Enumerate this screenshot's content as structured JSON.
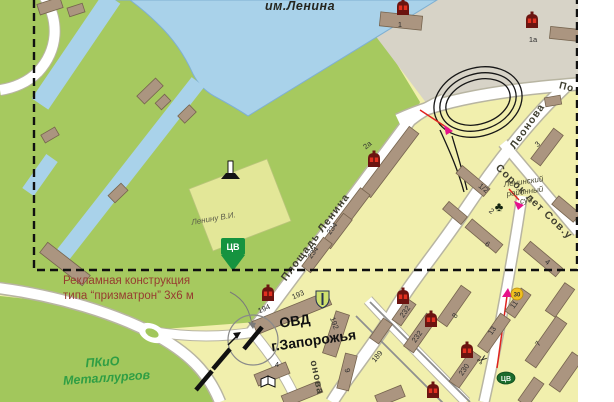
{
  "labels": {
    "park_top": "им.Ленина",
    "monument": "Ленину В.И.",
    "court1": "Ленинский",
    "court2": "районный",
    "court3": "суд",
    "ovd1": "ОВД",
    "ovd2": "г.Запорожья",
    "pkio1": "ПКиО",
    "pkio2": "Металлургов",
    "note1": "Рекламная конструкция",
    "note2": "типа “призматрон” 3х6 м",
    "marker_cv": "ЦВ",
    "oval_cv": "ЦВ",
    "sign_30": "30"
  },
  "streets": {
    "ploshad_lenina": "Площадь Ленина",
    "leonova": "Леонова",
    "sorok": "Сорок лет Сов.у",
    "p_top": "По",
    "onova": "онова"
  },
  "colors": {
    "park_green": "#a6c95f",
    "pkio_green": "#a2c75c",
    "water": "#a9d2ea",
    "water_edge": "#7fb0d2",
    "urban_gray": "#d7d3c7",
    "block_yellow": "#f1efad",
    "square_yellow_green": "#e3e798",
    "building_brown": "#ab9580",
    "building_edge": "#76644e",
    "road_white": "#ffffff",
    "road_casing": "#b8b5a2",
    "dashed_border": "#101010",
    "shop_icon_dark": "#6b1410",
    "shop_icon_red": "#e23020",
    "route_red": "#e0231e",
    "route_magenta": "#e6128a",
    "marker_green": "#15933f",
    "annotation_red": "#963c30",
    "tram_black": "#161616",
    "tram_gray": "#8f8f8f"
  },
  "buildings": [
    {
      "x": 50,
      "y": 6,
      "w": 24,
      "h": 11,
      "r": -18
    },
    {
      "x": 76,
      "y": 10,
      "w": 16,
      "h": 9,
      "r": -18
    },
    {
      "x": 150,
      "y": 91,
      "w": 26,
      "h": 11,
      "r": -44
    },
    {
      "x": 163,
      "y": 102,
      "w": 13,
      "h": 9,
      "r": -44
    },
    {
      "x": 187,
      "y": 114,
      "w": 16,
      "h": 10,
      "r": -44
    },
    {
      "x": 50,
      "y": 135,
      "w": 16,
      "h": 9,
      "r": -30
    },
    {
      "x": 118,
      "y": 193,
      "w": 18,
      "h": 10,
      "r": -44
    },
    {
      "x": 65,
      "y": 264,
      "w": 54,
      "h": 13,
      "r": 38
    },
    {
      "x": 401,
      "y": 21,
      "w": 42,
      "h": 14,
      "r": 6
    },
    {
      "x": 565,
      "y": 34,
      "w": 30,
      "h": 12,
      "r": 6
    },
    {
      "x": 553,
      "y": 101,
      "w": 16,
      "h": 9,
      "r": -10
    },
    {
      "x": 390,
      "y": 162,
      "w": 80,
      "h": 12,
      "r": -53
    },
    {
      "x": 352,
      "y": 209,
      "w": 44,
      "h": 12,
      "r": -53
    },
    {
      "x": 547,
      "y": 147,
      "w": 38,
      "h": 12,
      "r": -53
    },
    {
      "x": 566,
      "y": 209,
      "w": 28,
      "h": 11,
      "r": 40
    },
    {
      "x": 473,
      "y": 181,
      "w": 36,
      "h": 10,
      "r": 40
    },
    {
      "x": 455,
      "y": 213,
      "w": 24,
      "h": 10,
      "r": 40
    },
    {
      "x": 484,
      "y": 236,
      "w": 40,
      "h": 11,
      "r": 40
    },
    {
      "x": 543,
      "y": 259,
      "w": 42,
      "h": 11,
      "r": 40
    },
    {
      "x": 337,
      "y": 231,
      "w": 36,
      "h": 11,
      "r": -53
    },
    {
      "x": 317,
      "y": 255,
      "w": 36,
      "h": 11,
      "r": -53
    },
    {
      "x": 292,
      "y": 313,
      "w": 80,
      "h": 14,
      "r": -22
    },
    {
      "x": 336,
      "y": 334,
      "w": 14,
      "h": 44,
      "r": 18
    },
    {
      "x": 347,
      "y": 372,
      "w": 12,
      "h": 36,
      "r": 14
    },
    {
      "x": 272,
      "y": 374,
      "w": 34,
      "h": 12,
      "r": -22
    },
    {
      "x": 302,
      "y": 394,
      "w": 40,
      "h": 12,
      "r": -22
    },
    {
      "x": 454,
      "y": 306,
      "w": 42,
      "h": 12,
      "r": -55
    },
    {
      "x": 420,
      "y": 333,
      "w": 40,
      "h": 12,
      "r": -55
    },
    {
      "x": 404,
      "y": 312,
      "w": 26,
      "h": 11,
      "r": -55
    },
    {
      "x": 494,
      "y": 333,
      "w": 40,
      "h": 12,
      "r": -55
    },
    {
      "x": 518,
      "y": 303,
      "w": 28,
      "h": 12,
      "r": -55
    },
    {
      "x": 546,
      "y": 342,
      "w": 54,
      "h": 13,
      "r": -55
    },
    {
      "x": 465,
      "y": 369,
      "w": 38,
      "h": 12,
      "r": -55
    },
    {
      "x": 381,
      "y": 331,
      "w": 24,
      "h": 11,
      "r": -55
    },
    {
      "x": 560,
      "y": 300,
      "w": 34,
      "h": 12,
      "r": -55
    },
    {
      "x": 566,
      "y": 372,
      "w": 40,
      "h": 13,
      "r": -55
    },
    {
      "x": 531,
      "y": 392,
      "w": 28,
      "h": 12,
      "r": -55
    },
    {
      "x": 390,
      "y": 396,
      "w": 28,
      "h": 12,
      "r": -22
    }
  ],
  "building_numbers": [
    {
      "t": "1",
      "x": 400,
      "y": 27,
      "r": 0
    },
    {
      "t": "1a",
      "x": 533,
      "y": 42,
      "r": 0
    },
    {
      "t": "2a",
      "x": 369,
      "y": 147,
      "r": -40
    },
    {
      "t": "3",
      "x": 539,
      "y": 146,
      "r": -40
    },
    {
      "t": "1/2",
      "x": 482,
      "y": 190,
      "r": 38
    },
    {
      "t": "2",
      "x": 490,
      "y": 213,
      "r": 38
    },
    {
      "t": "6",
      "x": 486,
      "y": 246,
      "r": 38
    },
    {
      "t": "4",
      "x": 546,
      "y": 264,
      "r": 38
    },
    {
      "t": "234",
      "x": 334,
      "y": 230,
      "r": -53
    },
    {
      "t": "234",
      "x": 315,
      "y": 254,
      "r": -53
    },
    {
      "t": "194",
      "x": 265,
      "y": 311,
      "r": -24
    },
    {
      "t": "193",
      "x": 299,
      "y": 297,
      "r": -24
    },
    {
      "t": "192",
      "x": 332,
      "y": 324,
      "r": 70
    },
    {
      "t": "4",
      "x": 277,
      "y": 367,
      "r": 0
    },
    {
      "t": "9",
      "x": 345,
      "y": 371,
      "r": 76
    },
    {
      "t": "189",
      "x": 379,
      "y": 358,
      "r": -50
    },
    {
      "t": "8",
      "x": 457,
      "y": 317,
      "r": -55
    },
    {
      "t": "232",
      "x": 407,
      "y": 313,
      "r": -55
    },
    {
      "t": "232",
      "x": 419,
      "y": 338,
      "r": -55
    },
    {
      "t": "230",
      "x": 466,
      "y": 371,
      "r": -55
    },
    {
      "t": "13",
      "x": 494,
      "y": 332,
      "r": -55
    },
    {
      "t": "11",
      "x": 516,
      "y": 306,
      "r": -55
    },
    {
      "t": "7",
      "x": 540,
      "y": 345,
      "r": -55
    }
  ],
  "shop_icons": [
    {
      "x": 403,
      "y": 8
    },
    {
      "x": 532,
      "y": 21
    },
    {
      "x": 374,
      "y": 160
    },
    {
      "x": 268,
      "y": 294
    },
    {
      "x": 403,
      "y": 297
    },
    {
      "x": 431,
      "y": 320
    },
    {
      "x": 467,
      "y": 351
    },
    {
      "x": 433,
      "y": 391
    }
  ]
}
